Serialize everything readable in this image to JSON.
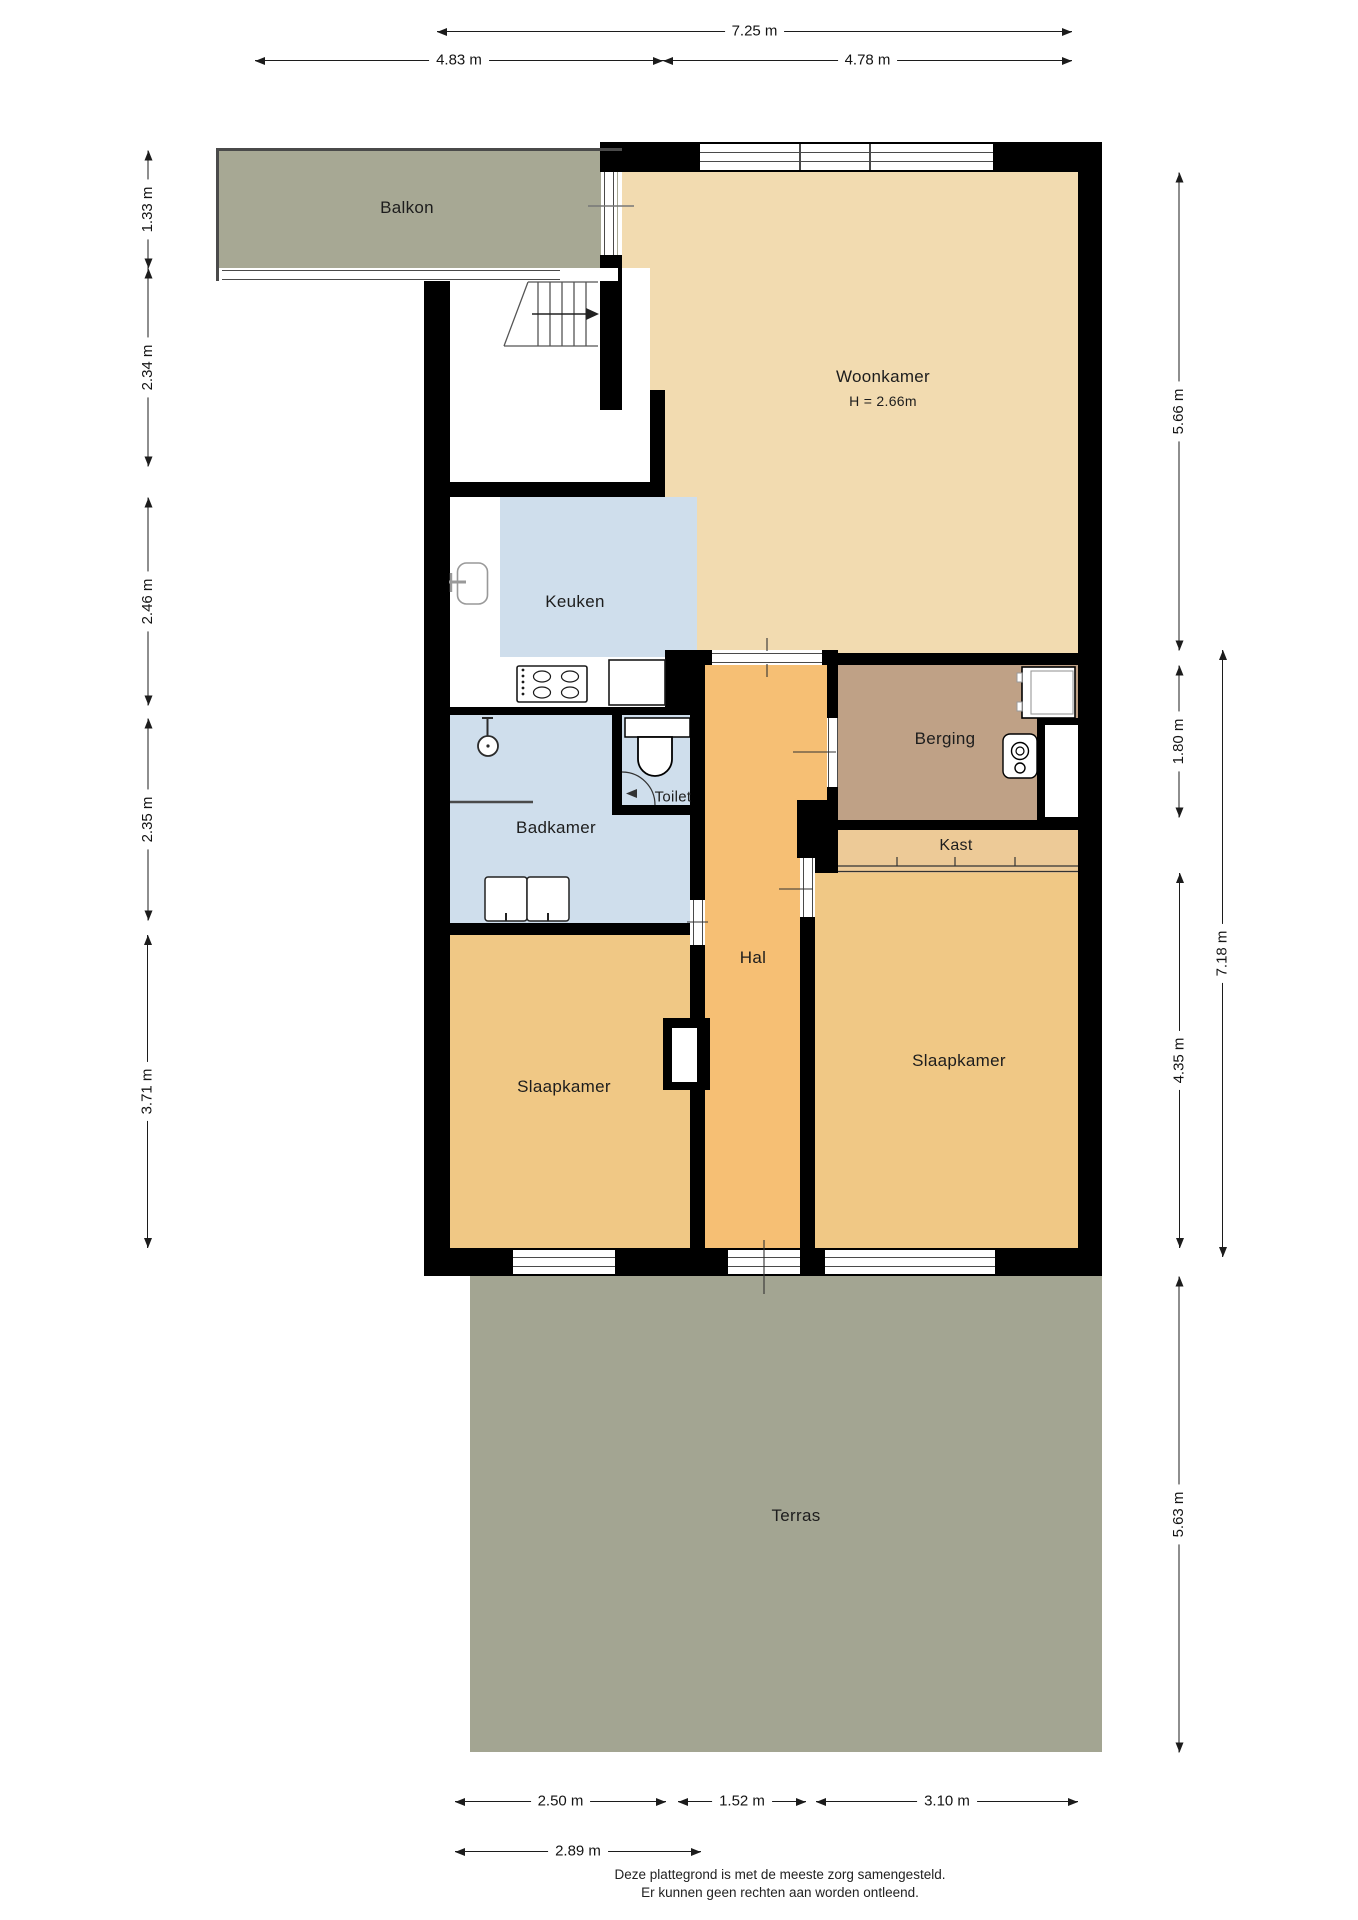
{
  "plan": {
    "rooms": {
      "balkon": {
        "label": "Balkon"
      },
      "woonkamer": {
        "label": "Woonkamer",
        "height_note": "H = 2.66m"
      },
      "keuken": {
        "label": "Keuken"
      },
      "badkamer": {
        "label": "Badkamer"
      },
      "toilet": {
        "label": "Toilet"
      },
      "hal": {
        "label": "Hal"
      },
      "berging": {
        "label": "Berging"
      },
      "kast": {
        "label": "Kast"
      },
      "slaapkamer_links": {
        "label": "Slaapkamer"
      },
      "slaapkamer_rechts": {
        "label": "Slaapkamer"
      },
      "terras": {
        "label": "Terras"
      }
    },
    "dimensions": {
      "top": [
        "7.25 m",
        "4.83 m",
        "4.78 m"
      ],
      "left": [
        "1.33 m",
        "2.34 m",
        "2.46 m",
        "2.35 m",
        "3.71 m"
      ],
      "right": [
        "5.66 m",
        "1.80 m",
        "4.35 m",
        "5.63 m",
        "7.18 m"
      ],
      "bottom": [
        "2.50 m",
        "1.52 m",
        "3.10 m",
        "2.89 m"
      ]
    },
    "footer": [
      "Deze plattegrond is met de meeste zorg samengesteld.",
      "Er kunnen geen rechten aan worden ontleend."
    ],
    "colors": {
      "wall": "#000000",
      "livingroom": "#F2DBB0",
      "hall": "#F6BF74",
      "storage": "#BFA186",
      "closet": "#EDCA97",
      "bedroom": "#F0C885",
      "bathroom": "#CFDEEC",
      "balcony": "#A7A894",
      "terrace": "#A3A592"
    }
  }
}
